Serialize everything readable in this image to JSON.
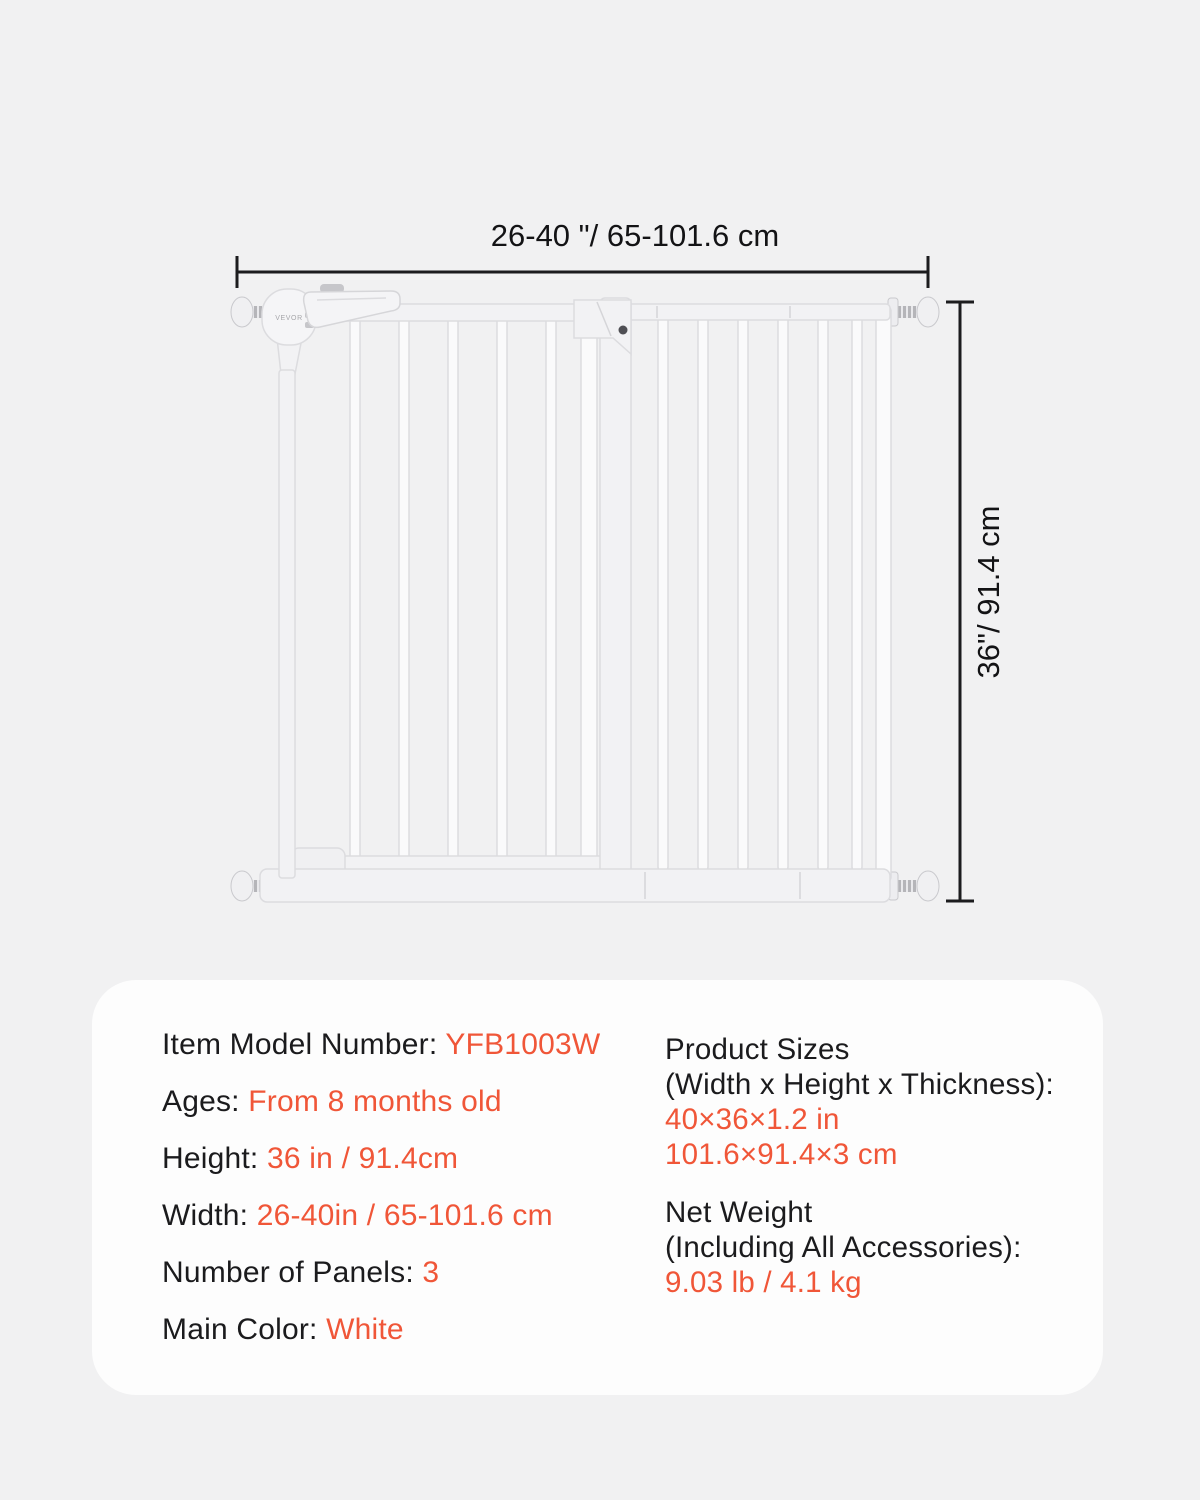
{
  "colors": {
    "accent": "#f05638",
    "text": "#1b1b1d",
    "card_background": "#fdfdfd",
    "page_background": "#f1f1f2",
    "dimension_line": "#1c1c1e",
    "gate_white": "#f4f4f6"
  },
  "diagram": {
    "width_label": "26-40 \"/ 65-101.6 cm",
    "height_label": "36\"/ 91.4 cm",
    "brand": "VEVOR"
  },
  "specs": {
    "left": [
      {
        "label": "Item Model Number: ",
        "value": "YFB1003W"
      },
      {
        "label": "Ages: ",
        "value": "From 8 months old"
      },
      {
        "label": "Height: ",
        "value": "36 in / 91.4cm"
      },
      {
        "label": "Width: ",
        "value": "26-40in / 65-101.6 cm"
      },
      {
        "label": "Number of Panels: ",
        "value": "3"
      },
      {
        "label": "Main Color: ",
        "value": "White"
      }
    ],
    "right": [
      {
        "title1": "Product Sizes",
        "title2": "(Width x Height x Thickness):",
        "value1": "40×36×1.2 in",
        "value2": "101.6×91.4×3 cm"
      },
      {
        "title1": "Net Weight",
        "title2": "(Including All Accessories):",
        "value1": "9.03 lb / 4.1 kg"
      }
    ]
  }
}
